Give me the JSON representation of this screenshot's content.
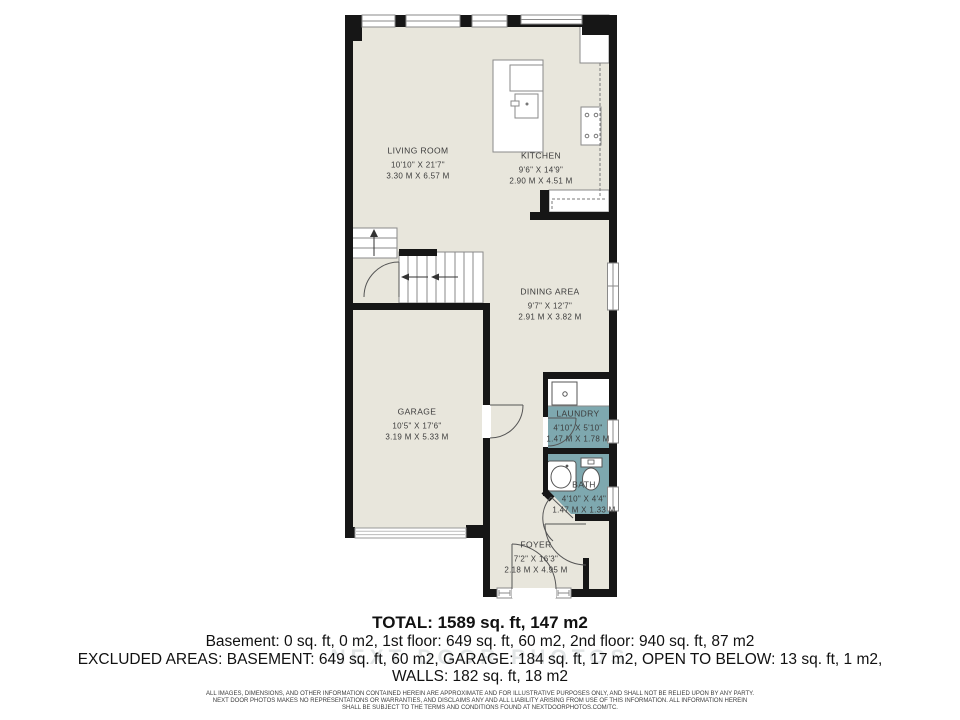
{
  "floor_plan": {
    "colors": {
      "floor": "#e8e6dc",
      "wet_room": "#7ea8af",
      "wall": "#161616",
      "fixture_line": "#8a8a8a",
      "label_text": "#3b3b3b"
    },
    "rooms": [
      {
        "id": "living-room",
        "name": "LIVING ROOM",
        "dims_imperial": "10'10\" X 21'7\"",
        "dims_metric": "3.30 M X 6.57 M"
      },
      {
        "id": "kitchen",
        "name": "KITCHEN",
        "dims_imperial": "9'6\" X 14'9\"",
        "dims_metric": "2.90 M X 4.51 M"
      },
      {
        "id": "dining-area",
        "name": "DINING AREA",
        "dims_imperial": "9'7\" X 12'7\"",
        "dims_metric": "2.91 M X 3.82 M"
      },
      {
        "id": "garage",
        "name": "GARAGE",
        "dims_imperial": "10'5\" X 17'6\"",
        "dims_metric": "3.19 M X 5.33 M"
      },
      {
        "id": "laundry",
        "name": "LAUNDRY",
        "dims_imperial": "4'10\" X 5'10\"",
        "dims_metric": "1.47 M X 1.78 M"
      },
      {
        "id": "bath",
        "name": "BATH",
        "dims_imperial": "4'10\" X 4'4\"",
        "dims_metric": "1.47 M X 1.33 M"
      },
      {
        "id": "foyer",
        "name": "FOYER",
        "dims_imperial": "7'2\" X 16'3\"",
        "dims_metric": "2.18 M X 4.95 M"
      }
    ]
  },
  "summary": {
    "total": "TOTAL: 1589 sq. ft, 147 m2",
    "floors": "Basement: 0 sq. ft, 0 m2, 1st floor: 649 sq. ft, 60 m2, 2nd floor: 940 sq. ft, 87 m2",
    "excluded": "EXCLUDED AREAS: BASEMENT: 649 sq. ft, 60 m2, GARAGE: 184 sq. ft, 17 m2, OPEN TO BELOW: 13 sq. ft, 1 m2,",
    "walls": "WALLS: 182 sq. ft, 18 m2"
  },
  "watermark": "NEXT DOOR PHOTOS",
  "disclaimer": {
    "line1": "ALL IMAGES, DIMENSIONS, AND OTHER INFORMATION CONTAINED HEREIN ARE APPROXIMATE AND FOR ILLUSTRATIVE PURPOSES ONLY, AND SHALL NOT BE RELIED UPON BY ANY PARTY.",
    "line2": "NEXT DOOR PHOTOS MAKES NO REPRESENTATIONS OR WARRANTIES, AND DISCLAIMS ANY AND ALL LIABILITY ARISING FROM USE OF THIS INFORMATION. ALL INFORMATION HEREIN",
    "line3": "SHALL BE SUBJECT TO THE TERMS AND CONDITIONS FOUND AT NEXTDOORPHOTOS.COM/TC."
  }
}
